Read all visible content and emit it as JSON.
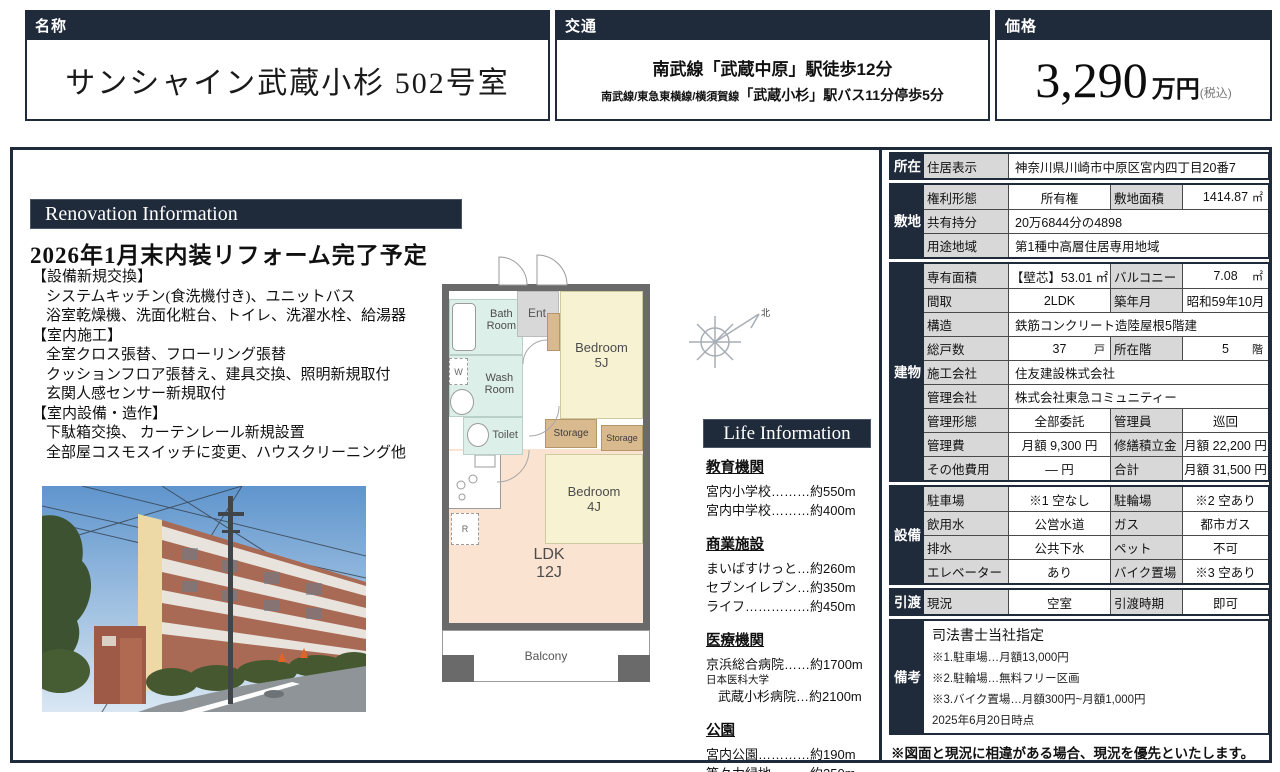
{
  "colors": {
    "navy": "#1f2a3a",
    "table_label_bg": "#d8d8d8",
    "plan_wall": "#6a6a6a",
    "room_bedroom": "#f7f2d2",
    "room_ldk": "#fbe3d1",
    "room_wet": "#ddefe9",
    "room_storage": "#d9b98e",
    "room_entrance": "#d8d8d8"
  },
  "header": {
    "name_label": "名称",
    "name_value": "サンシャイン武蔵小杉 502号室",
    "access_label": "交通",
    "access_line1": "南武線「武蔵中原」駅徒歩12分",
    "access_line2_prefix": "南武線/東急東横線/横須賀線",
    "access_line2_station": "「武蔵小杉」",
    "access_line2_suffix": "駅バス11分停歩5分",
    "price_label": "価格",
    "price_amount": "3,290",
    "price_unit": "万円",
    "price_tax": "(税込)"
  },
  "renovation": {
    "banner": "Renovation Information",
    "heading": "2026年1月末内装リフォーム完了予定",
    "lines": [
      "【設備新規交換】",
      "システムキッチン(食洗機付き)、ユニットバス",
      "浴室乾燥機、洗面化粧台、トイレ、洗濯水栓、給湯器",
      "【室内施工】",
      "全室クロス張替、フローリング張替",
      "クッションフロア張替え、建具交換、照明新規取付",
      "玄関人感センサー新規取付",
      "【室内設備・造作】",
      "下駄箱交換、 カーテンレール新規設置",
      "全部屋コスモスイッチに変更、ハウスクリーニング他"
    ]
  },
  "floorplan": {
    "ent": "Ent",
    "bath_l1": "Bath",
    "bath_l2": "Room",
    "w": "W",
    "wash_l1": "Wash",
    "wash_l2": "Room",
    "toilet": "Toilet",
    "bed5_name": "Bedroom",
    "bed5_size": "5J",
    "storage1": "Storage",
    "storage2": "Storage",
    "bed4_name": "Bedroom",
    "bed4_size": "4J",
    "ldk_name": "LDK",
    "ldk_size": "12J",
    "fridge": "R",
    "balcony": "Balcony",
    "north": "北"
  },
  "life": {
    "banner": "Life Information",
    "education_title": "教育機関",
    "education_items": [
      "宮内小学校………約550m",
      "宮内中学校………約400m"
    ],
    "shopping_title": "商業施設",
    "shopping_items": [
      "まいばすけっと…約260m",
      "セブンイレブン…約350m",
      "ライフ……………約450m"
    ],
    "medical_title": "医療機関",
    "medical_items": [
      "京浜総合病院……約1700m",
      "日本医科大学",
      "武蔵小杉病院…約2100m"
    ],
    "park_title": "公園",
    "park_items": [
      "宮内公園…………約190m",
      "等々力緑地………約250m"
    ]
  },
  "table": {
    "shozai_header": "所在",
    "address_label": "住居表示",
    "address_value": "神奈川県川崎市中原区宮内四丁目20番7",
    "shikichi_header": "敷地",
    "kenri_label": "権利形態",
    "kenri_value": "所有権",
    "menseki_label": "敷地面積",
    "menseki_value": "1414.87",
    "menseki_unit": "㎡",
    "kyoyu_label": "共有持分",
    "kyoyu_value": "20万6844分の4898",
    "yoto_label": "用途地域",
    "yoto_value": "第1種中高層住居専用地域",
    "tatemono_header": "建物",
    "senyu_label": "専有面積",
    "senyu_value": "【壁芯】53.01 ㎡",
    "balcony_label": "バルコニー",
    "balcony_value": "7.08",
    "balcony_unit": "㎡",
    "madori_label": "間取",
    "madori_value": "2LDK",
    "chikunen_label": "築年月",
    "chikunen_value": "昭和59年10月",
    "kozo_label": "構造",
    "kozo_value": "鉄筋コンクリート造陸屋根5階建",
    "kosu_label": "総戸数",
    "kosu_value": "37",
    "kosu_unit": "戸",
    "kai_label": "所在階",
    "kai_value": "5",
    "kai_unit": "階",
    "seko_label": "施工会社",
    "seko_value": "住友建設株式会社",
    "kanrigaisha_label": "管理会社",
    "kanrigaisha_value": "株式会社東急コミュニティー",
    "kanrikeitai_label": "管理形態",
    "kanrikeitai_value": "全部委託",
    "kanriin_label": "管理員",
    "kanriin_value": "巡回",
    "kanrihi_label": "管理費",
    "kanrihi_value": "月額 9,300 円",
    "shuzen_label": "修繕積立金",
    "shuzen_value": "月額 22,200 円",
    "sonota_label": "その他費用",
    "sonota_value": "― 円",
    "gokei_label": "合計",
    "gokei_value": "月額 31,500 円",
    "setsubi_header": "設備",
    "parking_label": "駐車場",
    "parking_value": "※1 空なし",
    "churin_label": "駐輪場",
    "churin_value": "※2 空あり",
    "water_label": "飲用水",
    "water_value": "公営水道",
    "gas_label": "ガス",
    "gas_value": "都市ガス",
    "haisui_label": "排水",
    "haisui_value": "公共下水",
    "pet_label": "ペット",
    "pet_value": "不可",
    "elevator_label": "エレベーター",
    "elevator_value": "あり",
    "bike_label": "バイク置場",
    "bike_value": "※3 空あり",
    "hikiwatashi_header": "引渡",
    "genkyo_label": "現況",
    "genkyo_value": "空室",
    "jiki_label": "引渡時期",
    "jiki_value": "即可",
    "biko_header": "備考",
    "biko_lines": [
      "司法書士当社指定",
      "※1.駐車場…月額13,000円",
      "※2.駐輪場…無料フリー区画",
      "※3.バイク置場…月額300円~月額1,000円",
      "2025年6月20日時点"
    ]
  },
  "footer_note": "※図面と現況に相違がある場合、現況を優先といたします。"
}
